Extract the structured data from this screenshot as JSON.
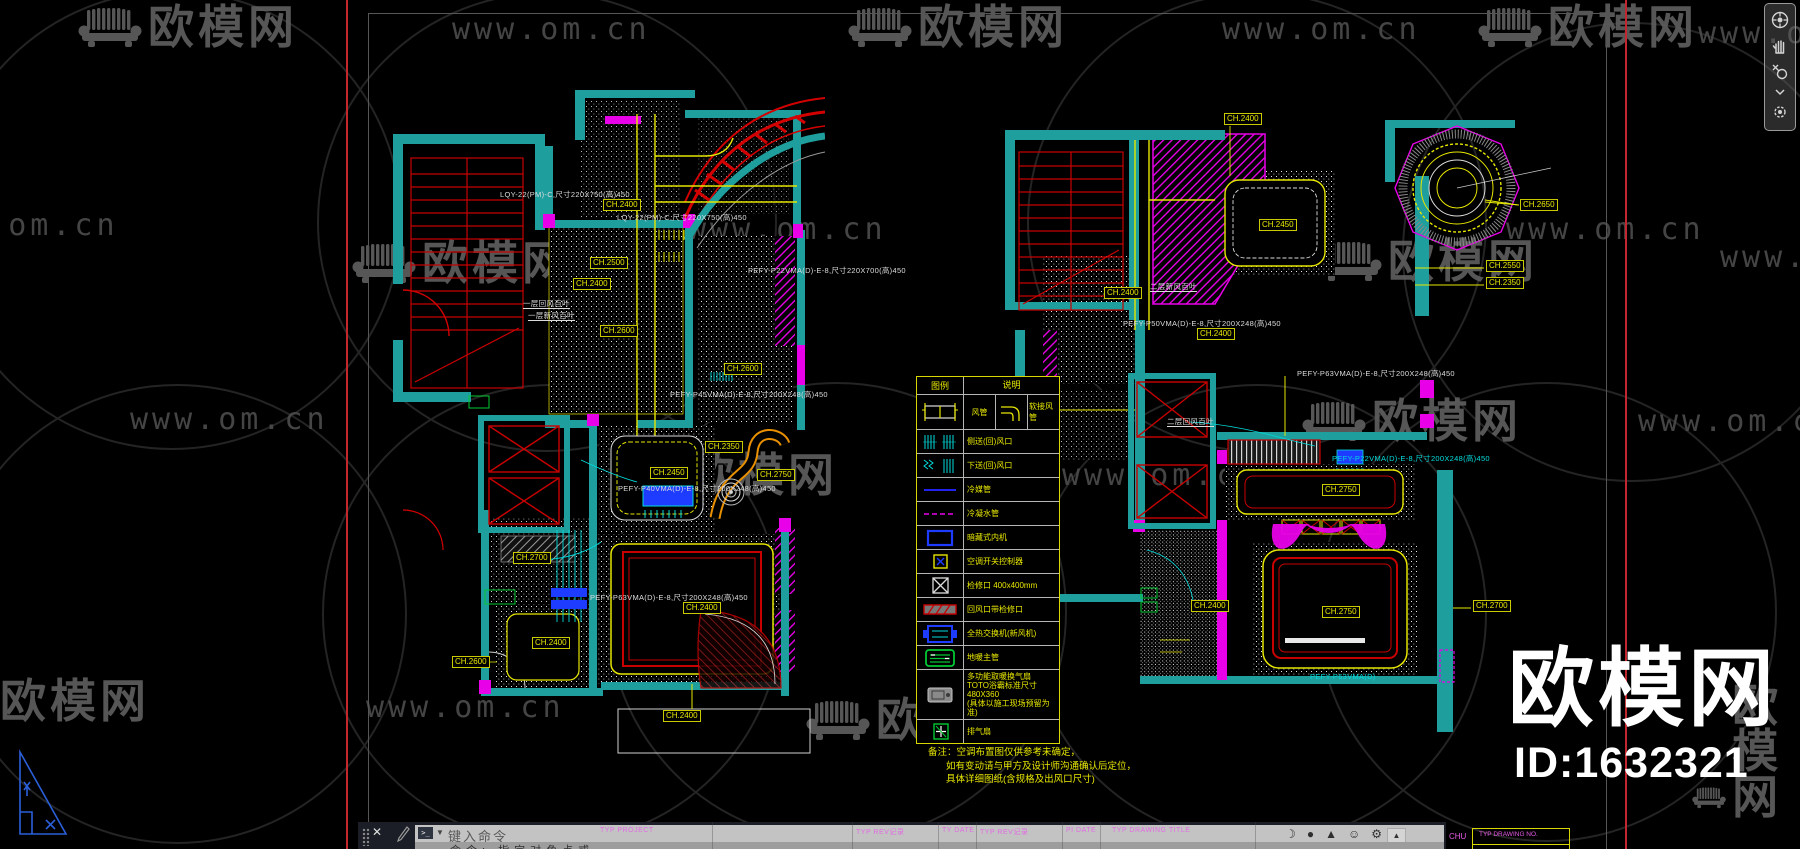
{
  "watermark": {
    "brand": "欧模网",
    "url": "www.om.cn",
    "circles": [
      {
        "cx": 170,
        "cy": 218
      },
      {
        "cx": 545,
        "cy": 220
      },
      {
        "cx": 1255,
        "cy": 220
      },
      {
        "cx": 1630,
        "cy": 250
      },
      {
        "cx": 175,
        "cy": 612
      },
      {
        "cx": 550,
        "cy": 612
      },
      {
        "cx": 835,
        "cy": 610
      },
      {
        "cx": 1255,
        "cy": 612
      },
      {
        "cx": 1545,
        "cy": 610
      }
    ],
    "logos": [
      {
        "x": 78,
        "y": 4
      },
      {
        "x": 848,
        "y": 4
      },
      {
        "x": 1478,
        "y": 4
      },
      {
        "x": 352,
        "y": 240
      },
      {
        "x": 1318,
        "y": 238
      },
      {
        "x": 618,
        "y": 452
      },
      {
        "x": 1302,
        "y": 398
      },
      {
        "x": -70,
        "y": 678
      },
      {
        "x": 806,
        "y": 697
      },
      {
        "x": 1692,
        "y": 682
      }
    ],
    "urls": [
      {
        "x": 452,
        "y": 12
      },
      {
        "x": 1222,
        "y": 12
      },
      {
        "x": 1698,
        "y": 16
      },
      {
        "x": -80,
        "y": 208
      },
      {
        "x": 688,
        "y": 212
      },
      {
        "x": 1506,
        "y": 212
      },
      {
        "x": 130,
        "y": 402
      },
      {
        "x": 1062,
        "y": 458
      },
      {
        "x": 1638,
        "y": 404
      },
      {
        "x": 366,
        "y": 690
      },
      {
        "x": 1720,
        "y": 240
      }
    ]
  },
  "branding": {
    "site": "欧模网",
    "model_id": "ID:1632321"
  },
  "left_plan": {
    "labels": [
      {
        "x": 603,
        "y": 205,
        "t": "CH.2400"
      },
      {
        "x": 590,
        "y": 263,
        "t": "CH.2500"
      },
      {
        "x": 573,
        "y": 284,
        "t": "CH.2400"
      },
      {
        "x": 600,
        "y": 331,
        "t": "CH.2600"
      },
      {
        "x": 724,
        "y": 369,
        "t": "CH.2600"
      },
      {
        "x": 705,
        "y": 447,
        "t": "CH.2350"
      },
      {
        "x": 650,
        "y": 473,
        "t": "CH.2450"
      },
      {
        "x": 757,
        "y": 475,
        "t": "CH.2750"
      },
      {
        "x": 513,
        "y": 558,
        "t": "CH.2700"
      },
      {
        "x": 452,
        "y": 662,
        "t": "CH.2600"
      },
      {
        "x": 532,
        "y": 643,
        "t": "CH.2400"
      },
      {
        "x": 683,
        "y": 608,
        "t": "CH.2400"
      },
      {
        "x": 663,
        "y": 716,
        "t": "CH.2400"
      }
    ],
    "texts": [
      {
        "x": 500,
        "y": 190,
        "t": "LQY-22(PM)-C,尺寸220X750(高)450"
      },
      {
        "x": 617,
        "y": 213,
        "t": "LQY-22(PM)-C,尺寸220X750(高)450"
      },
      {
        "x": 748,
        "y": 266,
        "t": "PEFY-P22VMA(D)-E-8,尺寸220X700(高)450"
      },
      {
        "x": 670,
        "y": 390,
        "t": "PEFY-P45VMA(D)-E-8,尺寸200X248(高)450"
      },
      {
        "x": 618,
        "y": 484,
        "t": "PEFY-P40VMA(D)-E-8,尺寸200X248(高)450"
      },
      {
        "x": 590,
        "y": 593,
        "t": "PEFY-P63VMA(D)-E-8,尺寸200X248(高)450"
      },
      {
        "x": 523,
        "y": 299,
        "t": "一层回风百叶",
        "u": 1
      },
      {
        "x": 528,
        "y": 311,
        "t": "一层新风百叶",
        "u": 1
      }
    ]
  },
  "right_plan": {
    "labels": [
      {
        "x": 1224,
        "y": 119,
        "t": "CH.2400"
      },
      {
        "x": 1520,
        "y": 205,
        "t": "CH.2650"
      },
      {
        "x": 1259,
        "y": 225,
        "t": "CH.2450"
      },
      {
        "x": 1486,
        "y": 266,
        "t": "CH.2550"
      },
      {
        "x": 1486,
        "y": 283,
        "t": "CH.2350"
      },
      {
        "x": 1104,
        "y": 293,
        "t": "CH.2400"
      },
      {
        "x": 1197,
        "y": 334,
        "t": "CH.2400"
      },
      {
        "x": 1322,
        "y": 490,
        "t": "CH.2750"
      },
      {
        "x": 1191,
        "y": 606,
        "t": "CH.2400"
      },
      {
        "x": 1322,
        "y": 612,
        "t": "CH.2750"
      },
      {
        "x": 1473,
        "y": 606,
        "t": "CH.2700"
      }
    ],
    "texts": [
      {
        "x": 1150,
        "y": 282,
        "t": "二层新风百叶",
        "u": 1
      },
      {
        "x": 1167,
        "y": 417,
        "t": "二层回风百叶",
        "u": 1
      },
      {
        "x": 1123,
        "y": 319,
        "t": "PEFY-P50VMA(D)-E-8,尺寸200X248(高)450"
      },
      {
        "x": 1297,
        "y": 369,
        "t": "PEFY-P63VMA(D)-E-8,尺寸200X248(高)450"
      },
      {
        "x": 1332,
        "y": 454,
        "t": "PEFY-P22VMA(D)-E-8,尺寸200X248(高)450",
        "c": 1
      },
      {
        "x": 1310,
        "y": 672,
        "t": "PEFY-P63VMA(D)",
        "c": 1
      }
    ]
  },
  "legend": {
    "header": {
      "symbol": "图例",
      "desc": "说明"
    },
    "duct_row": {
      "left": "风管",
      "right": "软接风管"
    },
    "rows": [
      {
        "symbol": "grille-side",
        "label": "侧送(回)风口"
      },
      {
        "symbol": "grille-down",
        "label": "下送(回)风口"
      },
      {
        "symbol": "line-solid-blue",
        "label": "冷媒管"
      },
      {
        "symbol": "line-dash-magenta",
        "label": "冷凝水管"
      },
      {
        "symbol": "rect-blue",
        "label": "暗藏式内机"
      },
      {
        "symbol": "ctrl-panel",
        "label": "空调开关控制器"
      },
      {
        "symbol": "box-x",
        "label": "检修口 400x400mm"
      },
      {
        "symbol": "return-grille",
        "label": "回风口带检修口"
      },
      {
        "symbol": "hrv",
        "label": "全热交换机(新风机)"
      },
      {
        "symbol": "manifold",
        "label": "地暖主管"
      },
      {
        "symbol": "bath-heater",
        "label": "多功能取暖换气扇",
        "sub": [
          "TOTO浴霸标准尺寸480X360",
          "(具体以施工现场预留为准)"
        ]
      },
      {
        "symbol": "exhaust-fan",
        "label": "排气扇"
      }
    ],
    "notes": [
      "备注：空调布置图仅供参考未确定，",
      "如有变动请与甲方及设计师沟通确认后定位，",
      "具体详细图纸(含规格及出风口尺寸)"
    ]
  },
  "command_bar": {
    "close": "✕",
    "prompt_label": "键入命令",
    "history_line": "命令: 指定对角点或",
    "titleblock_texts": [
      {
        "x": 242,
        "t": "TYP  PROJECT"
      },
      {
        "x": 498,
        "t": "TYP  REV记录"
      },
      {
        "x": 584,
        "t": "TY DATE"
      },
      {
        "x": 622,
        "t": "TYP  REV记录"
      },
      {
        "x": 708,
        "t": "PI DATE"
      },
      {
        "x": 754,
        "t": "TYP  DRAWING TITLE"
      }
    ],
    "tb_lines": [
      354,
      494,
      580,
      618,
      704,
      742,
      897
    ],
    "fragment": {
      "code": "CHU",
      "box_label": "TYP DRAWING NO."
    },
    "status_icons": [
      "crescent",
      "dot",
      "mountain",
      "face",
      "gear"
    ]
  },
  "colors": {
    "teal": "#1F9E9E",
    "yellow": "#E6E600",
    "magenta": "#E800E8",
    "red": "#C80000",
    "blue": "#1E3CFF",
    "cyan": "#00DCDC",
    "green": "#00C832",
    "orange": "#E89000",
    "watermark": "#5E5E5E",
    "accent_red_line": "#C1272D"
  }
}
